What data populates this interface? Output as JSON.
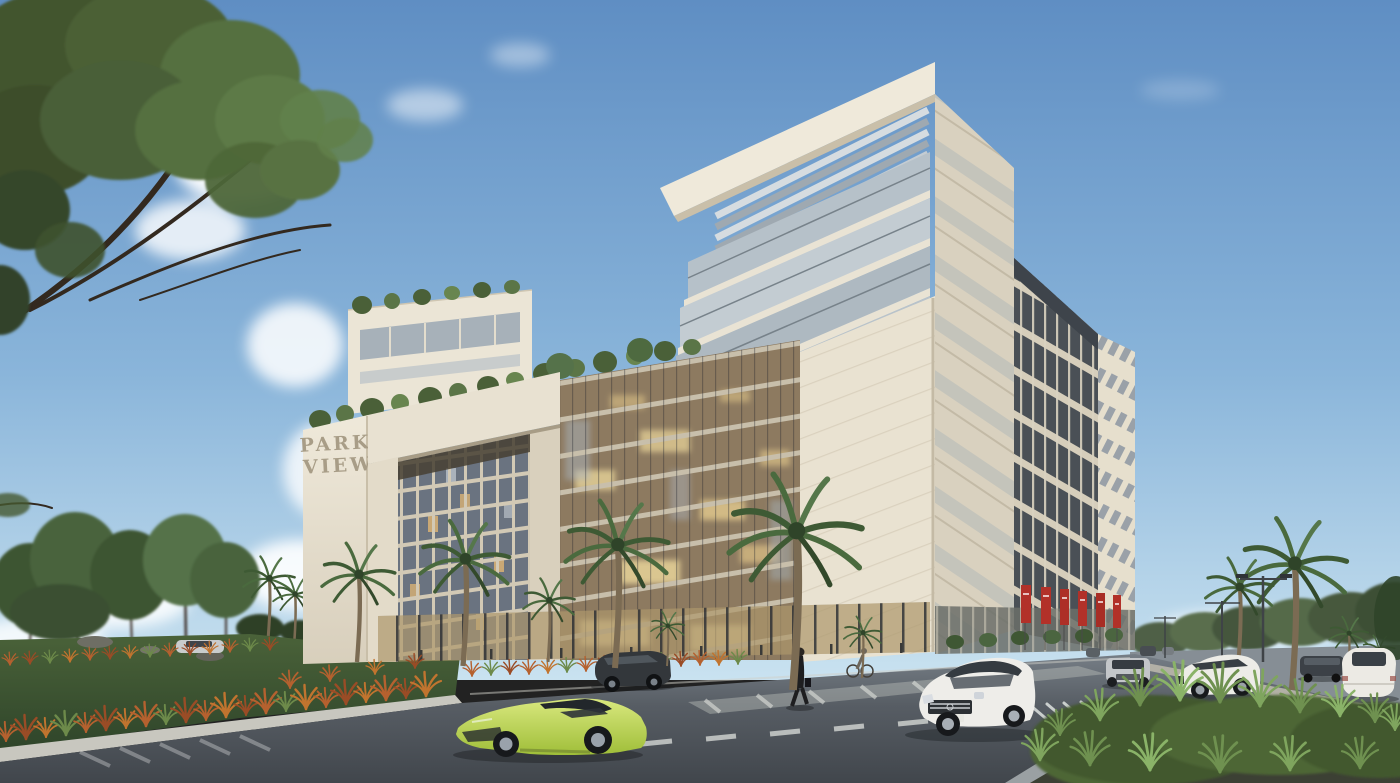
{
  "scene": {
    "type": "architectural-exterior-rendering",
    "description": "Daytime rendering of the Park View mixed-use development: cream stone building with louvered roof canopy, rooftop garden, glass curtain wall, stone portal frame, landscaped park, palm-lined boulevard and street traffic",
    "sky": "clear blue with soft white clouds"
  },
  "building": {
    "sign_line1": "PARK",
    "sign_line2": "VIEW",
    "features": [
      "cantilevered louvered roof crown",
      "glass balcony floors",
      "rooftop garden terrace with trees",
      "stone portal frame over gridded tower",
      "warm-lit glass curtain wall",
      "vertical fin side facade with recessed balconies",
      "street-level retail colonnade with red banners"
    ]
  },
  "palette": {
    "sky_top": "#5f8ec3",
    "sky_horizon": "#c9e2f0",
    "stone_light": "#ece6d7",
    "stone_shadow": "#d9d0bd",
    "glass_warm": "#d9b273",
    "glass_cool": "#aeb9c1",
    "banner_red": "#b23129",
    "lawn_green": "#47603a",
    "ornamental_grass_orange": "#b5612f",
    "asphalt": "#474c53",
    "supercar_lime": "#b7cf4e",
    "suv_white": "#eceae4"
  },
  "vehicles": [
    {
      "name": "lime-supercar",
      "detail": "lime green sports car, foreground"
    },
    {
      "name": "white-luxury-suv",
      "detail": "white SUV, front three-quarter view, center right"
    },
    {
      "name": "white-crossover",
      "detail": "white crossover crossing at right"
    },
    {
      "name": "silver-compact-suv",
      "detail": "small silver SUV, far lane"
    },
    {
      "name": "white-hatchback-rear",
      "detail": "white car seen from behind, far right"
    },
    {
      "name": "dark-distant-suv",
      "detail": "dark SUV in distance, right road"
    },
    {
      "name": "parked-dark-suv",
      "detail": "dark SUV parked at building forecourt"
    },
    {
      "name": "park-sedan",
      "detail": "light sedan behind park lawn"
    }
  ],
  "people": [
    {
      "name": "pedestrian-crossing",
      "detail": "figure in dark coat crossing the street"
    },
    {
      "name": "cyclist",
      "detail": "cyclist riding along the building sidewalk"
    }
  ],
  "vegetation": {
    "foreground_tree": "large leafy tree, top left corner",
    "park_trees": "grove of green trees on lawn, left",
    "palms": 13,
    "ornamental_grasses": "rows of orange-red grasses edging the lawn and sidewalk",
    "rooftop_garden": "row of trees along podium roof",
    "median_planter": "green grass planter island, bottom right"
  },
  "street": {
    "banner_count": 6,
    "banner_color": "#b23129",
    "markings": [
      "zebra crosswalk",
      "white chevron hatching",
      "lane dashes"
    ],
    "lights": "double-arm street lamps along right boulevard"
  }
}
